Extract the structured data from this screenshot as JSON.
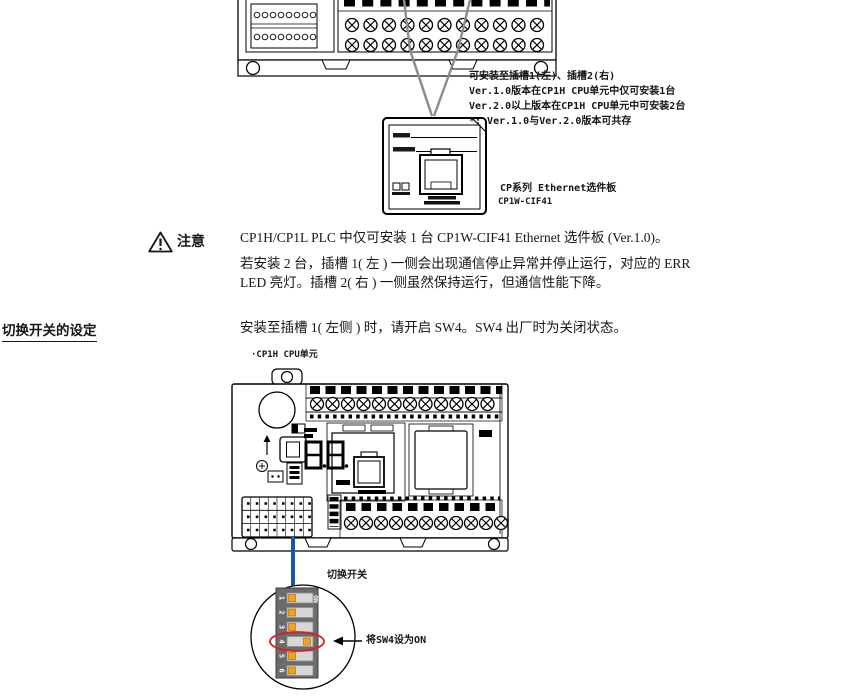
{
  "colors": {
    "blue_line": "#1b57a7",
    "red_highlight": "#dd1b21",
    "dip_body": "#6b6b6b",
    "dip_slot": "#d6d6d6",
    "dip_handle": "#f0a11e"
  },
  "top_figure": {
    "slot_note_lines": [
      "可安装至插槽1(左)、插槽2(右)",
      "Ver.1.0版本在CP1H CPU单元中仅可安装1台",
      "Ver.2.0以上版本在CP1H CPU单元中可安装2台",
      "*: Ver.1.0与Ver.2.0版本可共存"
    ],
    "board_caption_line1": "CP系列 Ethernet选件板",
    "board_caption_line2": "CP1W-CIF41"
  },
  "caution": {
    "label": "注意",
    "para1": "CP1H/CP1L PLC 中仅可安装 1 台 CP1W-CIF41 Ethernet 选件板 (Ver.1.0)。",
    "para2_line1": "若安装 2 台，插槽 1( 左 ) 一侧会出现通信停止异常并停止运行，对应的 ERR",
    "para2_line2": "LED 亮灯。插槽 2( 右 ) 一侧虽然保持运行，但通信性能下降。"
  },
  "switch_section": {
    "heading": "切换开关的设定",
    "body": "安装至插槽 1( 左侧 ) 时，请开启 SW4。SW4 出厂时为关闭状态。",
    "unit_label": "·CP1H CPU单元",
    "switch_label": "切换开关",
    "arrow_note": "将SW4设为ON",
    "dip": {
      "on_label": "ON",
      "switches": [
        {
          "num": "1",
          "state": "off"
        },
        {
          "num": "2",
          "state": "off"
        },
        {
          "num": "3",
          "state": "off"
        },
        {
          "num": "4",
          "state": "on"
        },
        {
          "num": "5",
          "state": "off"
        },
        {
          "num": "6",
          "state": "off"
        }
      ]
    }
  }
}
